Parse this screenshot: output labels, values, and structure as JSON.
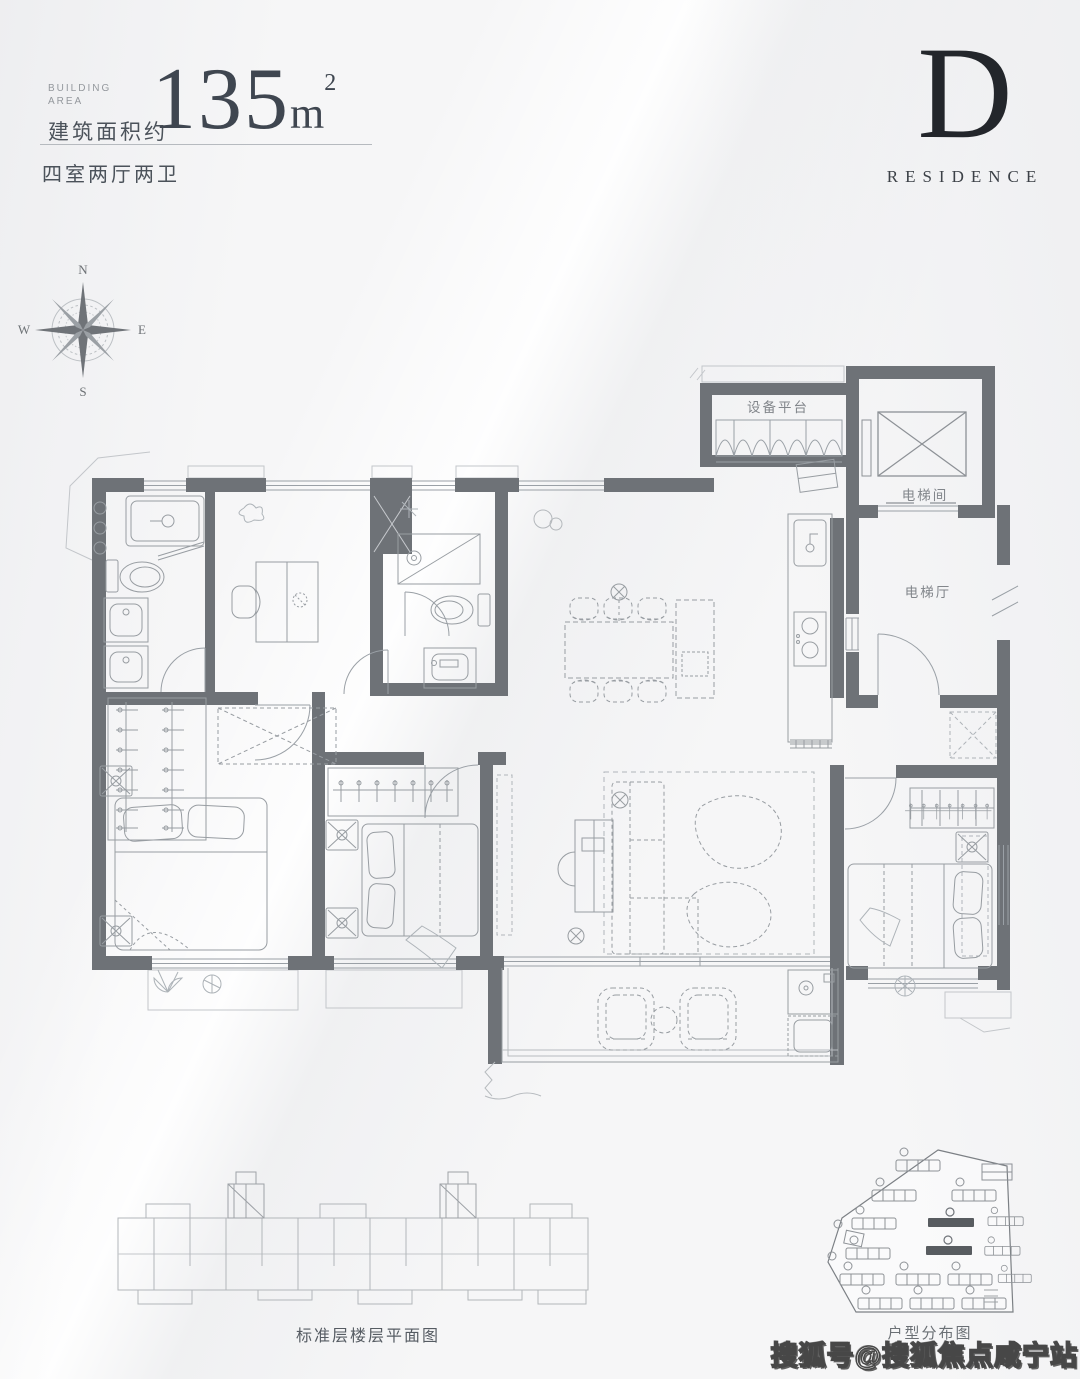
{
  "header": {
    "building_area_en_line1": "BUILDING",
    "building_area_en_line2": "AREA",
    "building_area_cn": "建筑面积约",
    "area_number": "135",
    "area_unit": "m",
    "area_sup": "2",
    "layout": "四室两厅两卫"
  },
  "badge": {
    "letter": "D",
    "word": "RESIDENCE"
  },
  "compass": {
    "n": "N",
    "e": "E",
    "s": "S",
    "w": "W"
  },
  "plan": {
    "labels": {
      "equipment_platform": "设备平台",
      "elevator_room": "电梯间",
      "elevator_hall": "电梯厅"
    }
  },
  "captions": {
    "standard_floor": "标准层楼层平面图",
    "unit_distribution": "户型分布图"
  },
  "watermark": {
    "text": "搜狐号@搜狐焦点咸宁站"
  },
  "colors": {
    "background": "#f6f6f7",
    "wall": "#6e7277",
    "furniture_line": "#989da2",
    "dashed_line": "#aeb3b8",
    "thin_outline": "#c3c6ca",
    "header_text": "#3f4650",
    "badge_black": "#23262b",
    "label_gray": "#82868b",
    "site_dark": "#585c60"
  }
}
